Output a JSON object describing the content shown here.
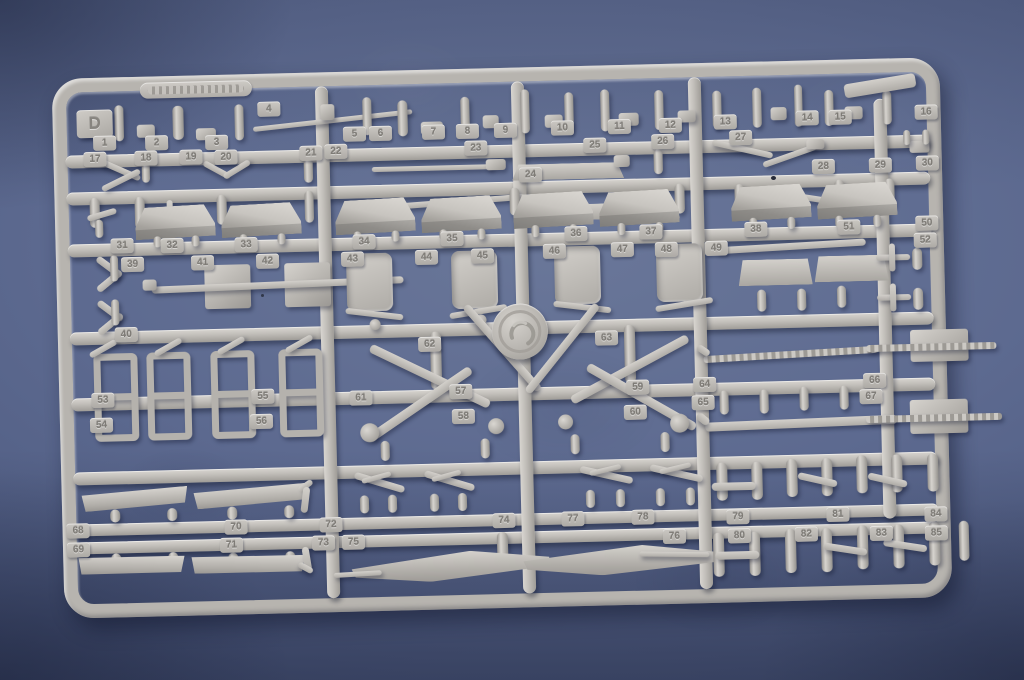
{
  "photo": {
    "kind": "model-kit-sprue",
    "colors": {
      "background": "#57648b",
      "background_shadow": "#3f4a6d",
      "plastic": "#b8b5b0",
      "plastic_highlight": "#dbd8d3",
      "plastic_shadow": "#8f8d89"
    }
  },
  "sprue": {
    "letter": "D",
    "tags": [
      {
        "n": "1",
        "x": 40,
        "y": 58
      },
      {
        "n": "2",
        "x": 92,
        "y": 59
      },
      {
        "n": "3",
        "x": 152,
        "y": 60
      },
      {
        "n": "4",
        "x": 205,
        "y": 28
      },
      {
        "n": "5",
        "x": 290,
        "y": 55
      },
      {
        "n": "6",
        "x": 316,
        "y": 55
      },
      {
        "n": "7",
        "x": 369,
        "y": 55
      },
      {
        "n": "8",
        "x": 403,
        "y": 55
      },
      {
        "n": "9",
        "x": 441,
        "y": 55
      },
      {
        "n": "10",
        "x": 498,
        "y": 54
      },
      {
        "n": "11",
        "x": 555,
        "y": 54
      },
      {
        "n": "12",
        "x": 606,
        "y": 54
      },
      {
        "n": "13",
        "x": 661,
        "y": 52
      },
      {
        "n": "14",
        "x": 743,
        "y": 50
      },
      {
        "n": "15",
        "x": 776,
        "y": 50
      },
      {
        "n": "16",
        "x": 862,
        "y": 47
      },
      {
        "n": "17",
        "x": 30,
        "y": 74
      },
      {
        "n": "18",
        "x": 81,
        "y": 74
      },
      {
        "n": "19",
        "x": 126,
        "y": 74
      },
      {
        "n": "20",
        "x": 161,
        "y": 75
      },
      {
        "n": "21",
        "x": 246,
        "y": 73
      },
      {
        "n": "22",
        "x": 271,
        "y": 72
      },
      {
        "n": "23",
        "x": 411,
        "y": 72
      },
      {
        "n": "24",
        "x": 465,
        "y": 100
      },
      {
        "n": "25",
        "x": 530,
        "y": 72
      },
      {
        "n": "26",
        "x": 598,
        "y": 70
      },
      {
        "n": "27",
        "x": 676,
        "y": 68
      },
      {
        "n": "28",
        "x": 758,
        "y": 99
      },
      {
        "n": "29",
        "x": 815,
        "y": 99
      },
      {
        "n": "30",
        "x": 862,
        "y": 98
      },
      {
        "n": "31",
        "x": 55,
        "y": 161
      },
      {
        "n": "32",
        "x": 105,
        "y": 162
      },
      {
        "n": "33",
        "x": 179,
        "y": 163
      },
      {
        "n": "34",
        "x": 297,
        "y": 163
      },
      {
        "n": "35",
        "x": 385,
        "y": 162
      },
      {
        "n": "36",
        "x": 509,
        "y": 160
      },
      {
        "n": "37",
        "x": 584,
        "y": 160
      },
      {
        "n": "38",
        "x": 689,
        "y": 160
      },
      {
        "n": "51",
        "x": 782,
        "y": 160
      },
      {
        "n": "50",
        "x": 860,
        "y": 158
      },
      {
        "n": "39",
        "x": 65,
        "y": 180
      },
      {
        "n": "40",
        "x": 57,
        "y": 250
      },
      {
        "n": "41",
        "x": 135,
        "y": 180
      },
      {
        "n": "42",
        "x": 200,
        "y": 180
      },
      {
        "n": "43",
        "x": 285,
        "y": 180
      },
      {
        "n": "44",
        "x": 359,
        "y": 180
      },
      {
        "n": "45",
        "x": 415,
        "y": 180
      },
      {
        "n": "46",
        "x": 487,
        "y": 177
      },
      {
        "n": "47",
        "x": 555,
        "y": 177
      },
      {
        "n": "48",
        "x": 599,
        "y": 178
      },
      {
        "n": "49",
        "x": 649,
        "y": 178
      },
      {
        "n": "52",
        "x": 858,
        "y": 175
      },
      {
        "n": "53",
        "x": 32,
        "y": 315
      },
      {
        "n": "54",
        "x": 30,
        "y": 340
      },
      {
        "n": "55",
        "x": 192,
        "y": 315
      },
      {
        "n": "56",
        "x": 190,
        "y": 340
      },
      {
        "n": "57",
        "x": 390,
        "y": 315
      },
      {
        "n": "58",
        "x": 392,
        "y": 340
      },
      {
        "n": "59",
        "x": 567,
        "y": 315
      },
      {
        "n": "60",
        "x": 564,
        "y": 340
      },
      {
        "n": "61",
        "x": 290,
        "y": 319
      },
      {
        "n": "62",
        "x": 360,
        "y": 267
      },
      {
        "n": "63",
        "x": 537,
        "y": 265
      },
      {
        "n": "64",
        "x": 634,
        "y": 314
      },
      {
        "n": "65",
        "x": 632,
        "y": 332
      },
      {
        "n": "66",
        "x": 804,
        "y": 314
      },
      {
        "n": "67",
        "x": 800,
        "y": 330
      },
      {
        "n": "68",
        "x": 4,
        "y": 445
      },
      {
        "n": "69",
        "x": 4,
        "y": 464
      },
      {
        "n": "70",
        "x": 162,
        "y": 445
      },
      {
        "n": "71",
        "x": 157,
        "y": 463
      },
      {
        "n": "72",
        "x": 257,
        "y": 445
      },
      {
        "n": "73",
        "x": 249,
        "y": 463
      },
      {
        "n": "74",
        "x": 430,
        "y": 445
      },
      {
        "n": "75",
        "x": 279,
        "y": 463
      },
      {
        "n": "76",
        "x": 600,
        "y": 465
      },
      {
        "n": "77",
        "x": 499,
        "y": 445
      },
      {
        "n": "78",
        "x": 569,
        "y": 445
      },
      {
        "n": "79",
        "x": 664,
        "y": 447
      },
      {
        "n": "80",
        "x": 665,
        "y": 466
      },
      {
        "n": "81",
        "x": 764,
        "y": 447
      },
      {
        "n": "82",
        "x": 732,
        "y": 466
      },
      {
        "n": "83",
        "x": 807,
        "y": 467
      },
      {
        "n": "84",
        "x": 862,
        "y": 449
      },
      {
        "n": "85",
        "x": 862,
        "y": 468
      }
    ]
  }
}
